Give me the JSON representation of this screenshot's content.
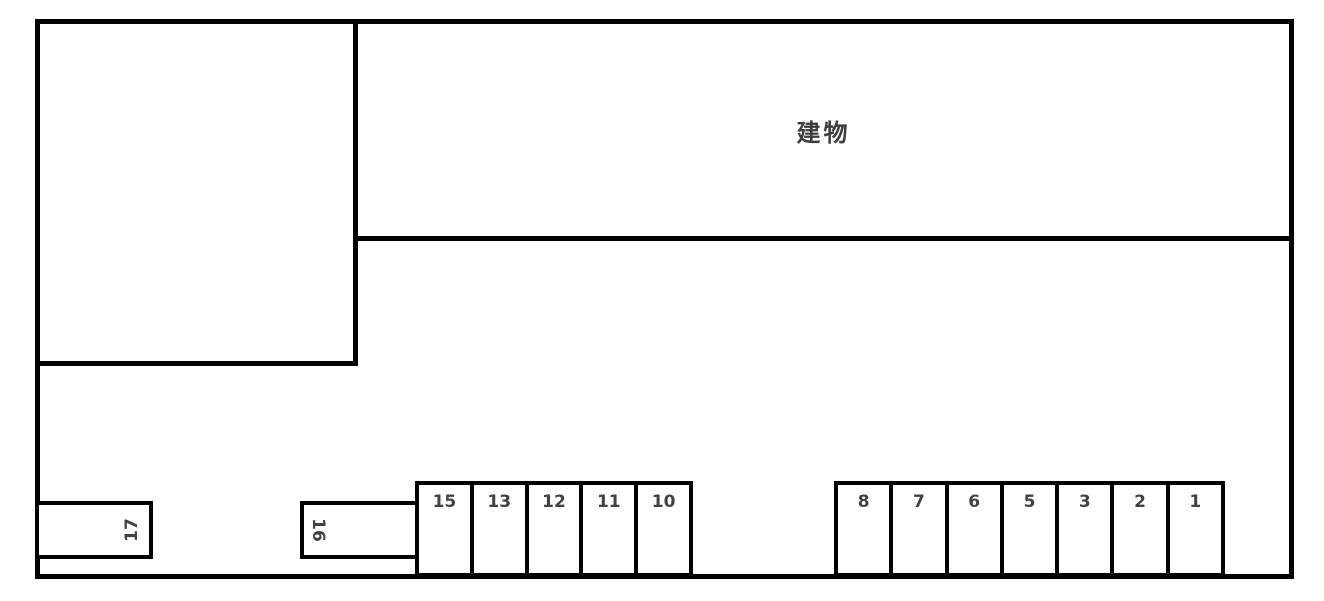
{
  "diagram": {
    "building_label": "建物",
    "horizontal_stalls": [
      {
        "number": "17"
      },
      {
        "number": "16"
      }
    ],
    "left_stall_group": [
      "15",
      "13",
      "12",
      "11",
      "10"
    ],
    "right_stall_group": [
      "8",
      "7",
      "6",
      "5",
      "3",
      "2",
      "1"
    ],
    "colors": {
      "line": "#000000",
      "number_text": "#424242",
      "background": "#ffffff"
    }
  }
}
